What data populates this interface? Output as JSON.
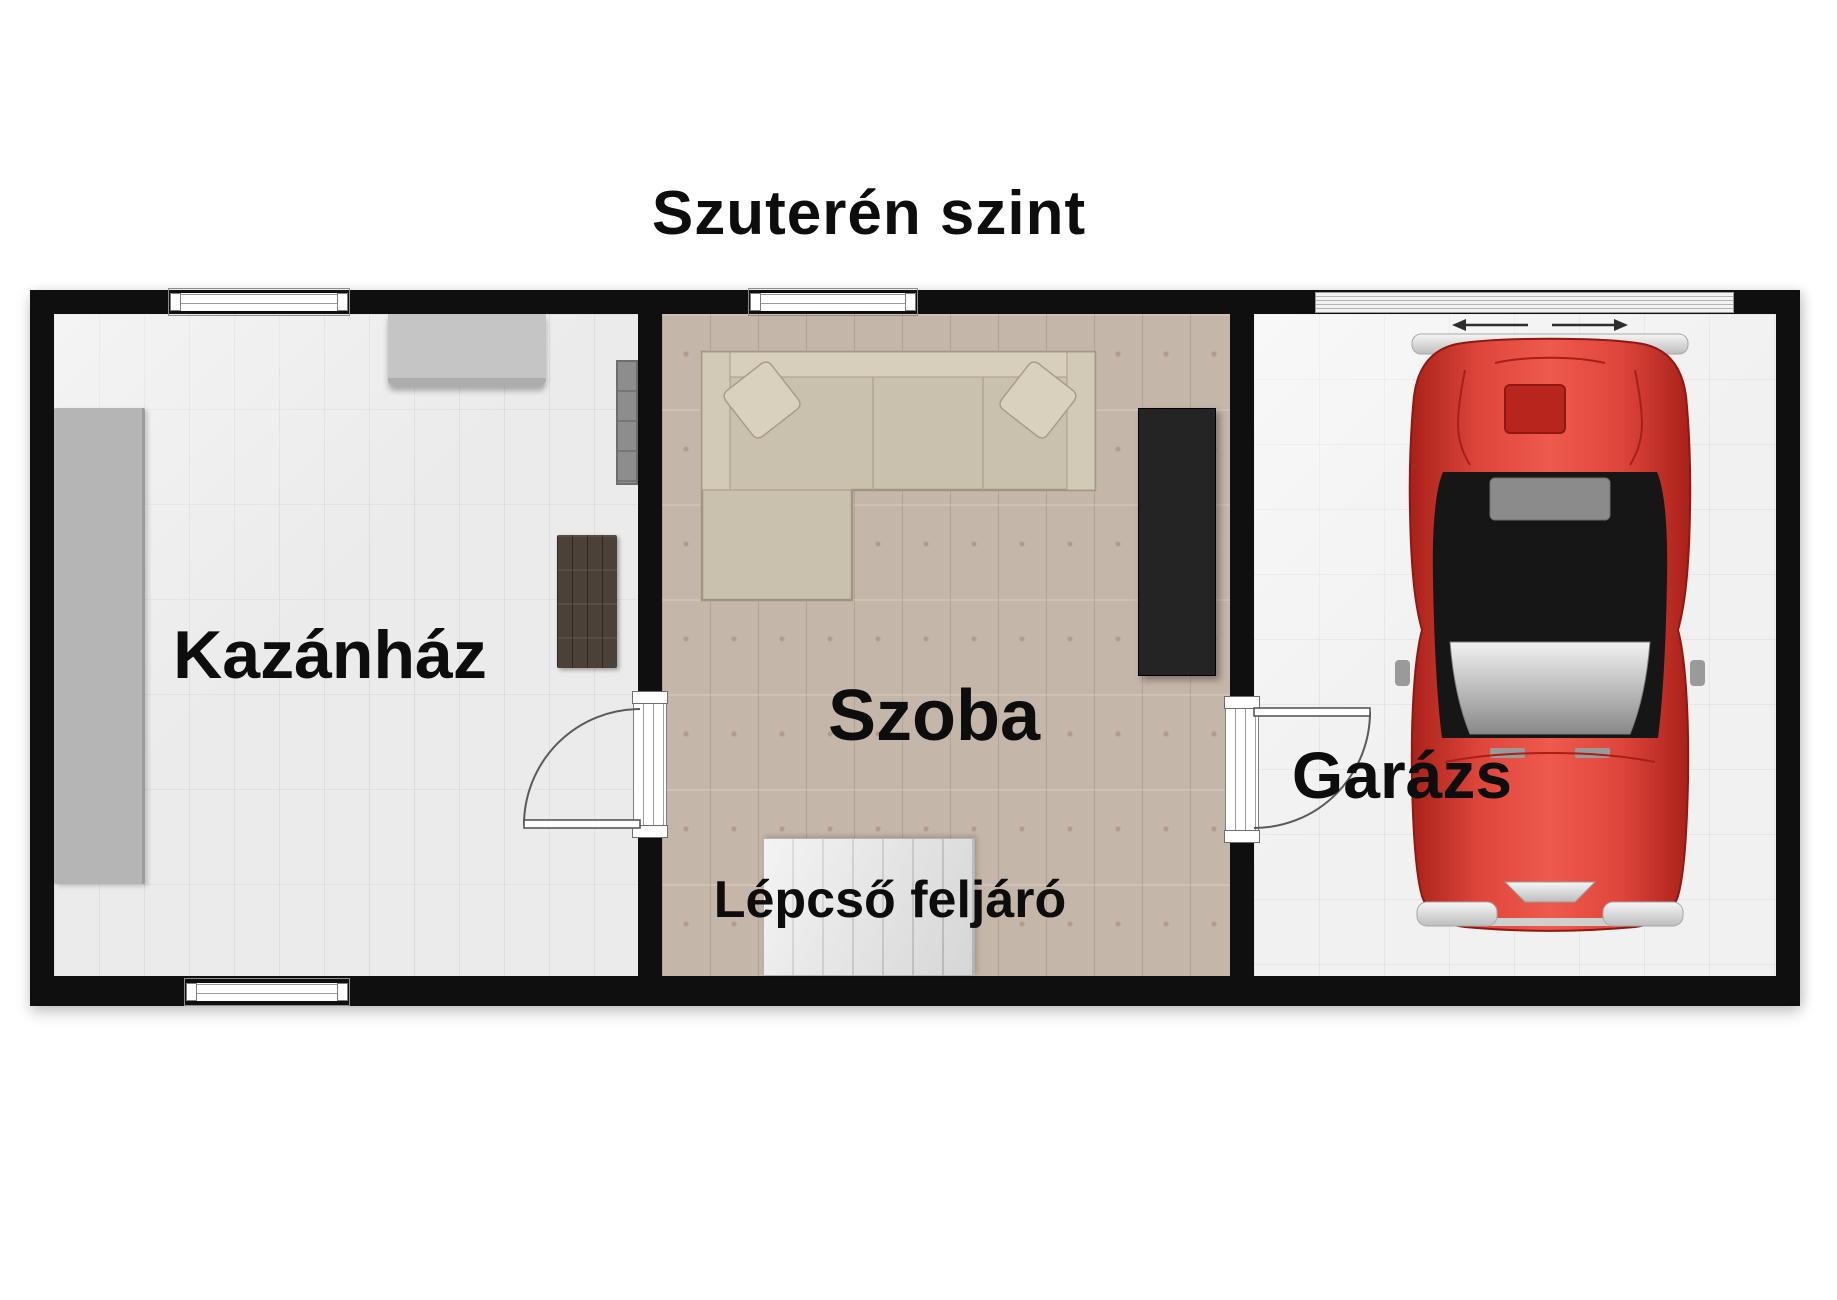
{
  "title": "Szuterén szint",
  "plan": {
    "rooms": {
      "kazanhaz": {
        "label": "Kazánház"
      },
      "szoba": {
        "label": "Szoba"
      },
      "garazs": {
        "label": "Garázs"
      }
    },
    "stairs_label": "Lépcső feljáró",
    "colors": {
      "wall": "#0f0f0f",
      "tile_floor": "#ebebeb",
      "garage_floor": "#f1f1f1",
      "wood_floor": "#ccbdb0",
      "sofa_beige": "#c9c0ae",
      "wardrobe_dark": "#242424",
      "stairs_gray": "#e6e6e6",
      "rug_brown": "#4c4138",
      "car_red": "#d9382e"
    }
  }
}
